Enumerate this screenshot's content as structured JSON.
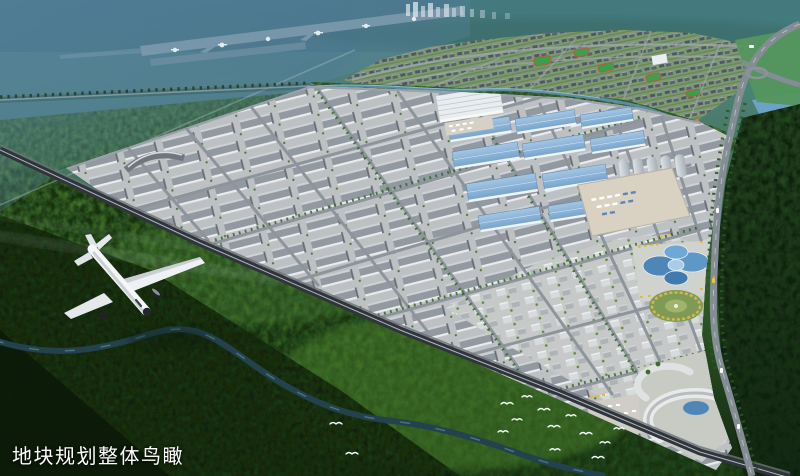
{
  "caption": {
    "text": "地块规划整体鸟瞰"
  },
  "palette": {
    "haze_blue": "#4a7389",
    "haze_teal": "#4f8078",
    "distant_green": "#3f8a70",
    "forest_dark": "#13260f",
    "meadow_green": "#4d8030",
    "park_ground": "#bcc0c3",
    "factory_roof_gray": "#8d939b",
    "factory_roof_blue": "#86b0d6",
    "warehouse_white": "#e9edf0",
    "road_gray": "#858d94",
    "rail_corridor": "#2f353a",
    "river_blue": "#23424e",
    "plaza_yellow": "#d8b84e",
    "caption_white": "#ffffff"
  },
  "scene_elements": [
    "airport-runway",
    "taxiing-planes",
    "distant-city-towers",
    "residential-district",
    "sports-fields",
    "greenbelt-river",
    "industrial-park",
    "gray-factory-rows",
    "blue-roof-factories",
    "silver-hangars",
    "logistics-yard",
    "flower-roof-pavilion",
    "circular-plaza",
    "exhibition-complex",
    "railway-corridor",
    "highway",
    "flying-airplane",
    "egret-birds",
    "winding-river",
    "forest-hills",
    "caption-text"
  ]
}
